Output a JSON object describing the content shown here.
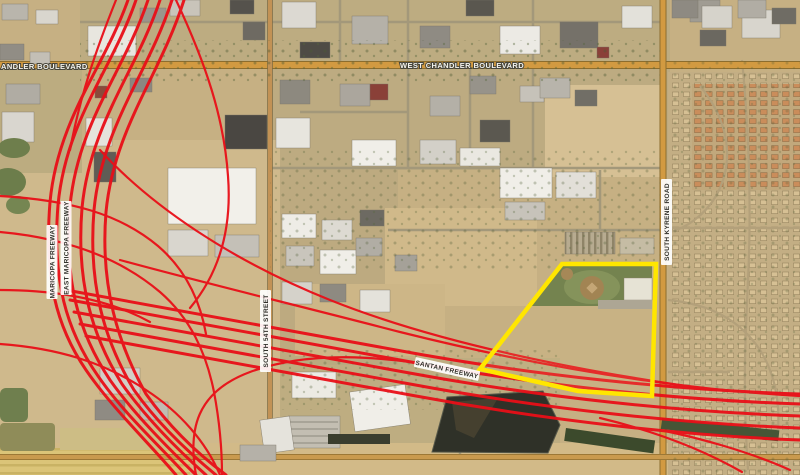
{
  "map": {
    "type": "aerial-satellite-map",
    "description": "Aerial map of freeway interchange area with highlighted parcel",
    "colors": {
      "freeway_overlay": "#e90f18",
      "parcel_outline": "#ffe600",
      "arterial_road": "#d29a41",
      "desert": "#c6b083",
      "park_green": "#677a47",
      "basin_dark": "#2f3128"
    },
    "highlighted_parcel": "yellow outlined vacant parcel with park and ballfields"
  },
  "labels": {
    "chandler_blvd_partial": "ANDLER BOULEVARD",
    "west_chandler_blvd": "WEST CHANDLER BOULEVARD",
    "maricopa_freeway": "MARICOPA FREEWAY",
    "east_maricopa_freeway": "EAST MARICOPA FREEWAY",
    "south_54th_street": "SOUTH 54TH STREET",
    "south_kyrene_road": "SOUTH KYRENE ROAD",
    "santan_freeway": "SANTAN FREEWAY"
  }
}
